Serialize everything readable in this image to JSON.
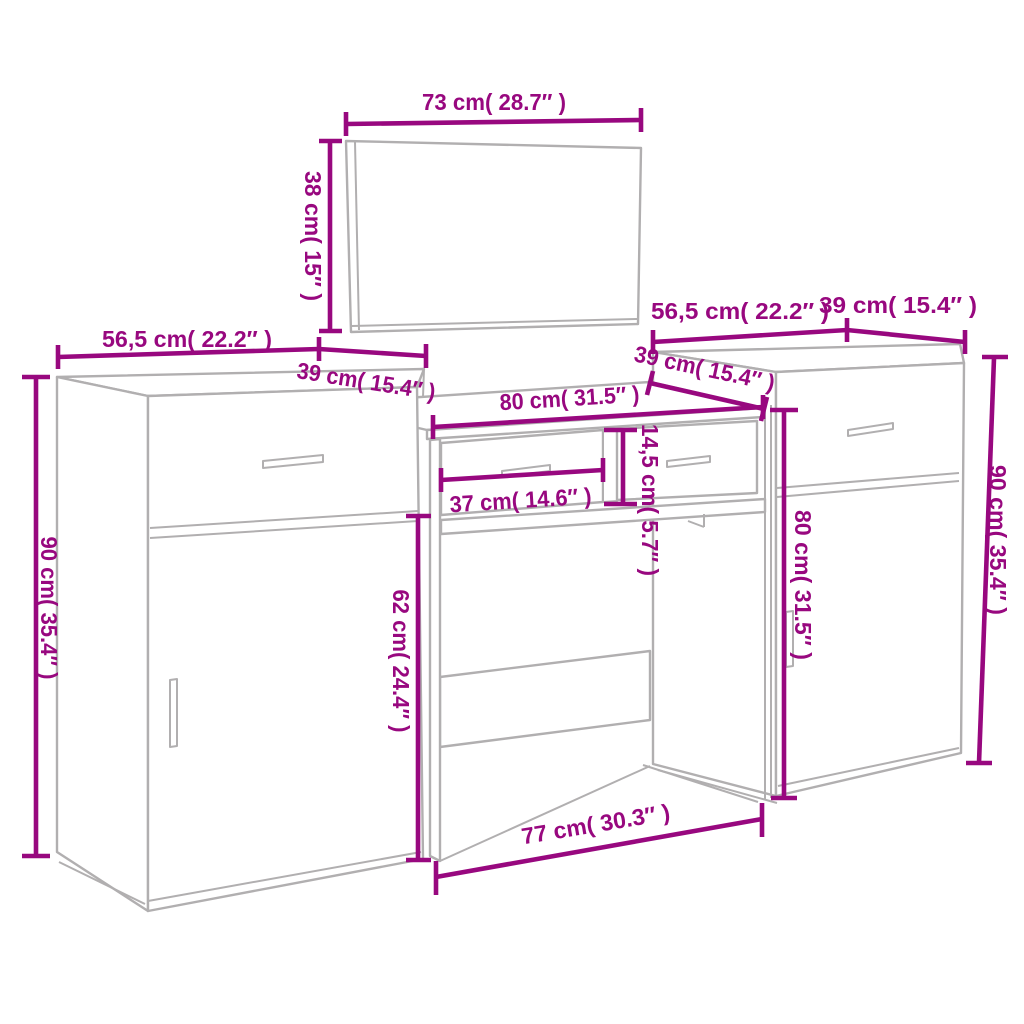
{
  "diagram": {
    "kind": "furniture-dimension-diagram",
    "colors": {
      "dimension": "#98087f",
      "furniture_outline": "#b1afb0",
      "background": "#ffffff"
    },
    "units": {
      "metric": "cm",
      "imperial": "in"
    },
    "pieces": {
      "mirror": {
        "width": {
          "cm": "73",
          "in": "28.7",
          "label": "73 cm( 28.7″ )"
        },
        "height": {
          "cm": "38",
          "in": "15",
          "label": "38 cm( 15″ )"
        }
      },
      "left_cabinet": {
        "width": {
          "cm": "56,5",
          "in": "22.2",
          "label": "56,5 cm( 22.2″ )"
        },
        "depth": {
          "cm": "39",
          "in": "15.4",
          "label": "39 cm( 15.4″ )"
        },
        "height": {
          "cm": "90",
          "in": "35.4",
          "label": "90 cm( 35.4″ )"
        }
      },
      "dressing_table": {
        "width": {
          "cm": "80",
          "in": "31.5",
          "label": "80 cm( 31.5″ )"
        },
        "depth": {
          "cm": "39",
          "in": "15.4",
          "label": "39 cm( 15.4″ )"
        },
        "drawer_width": {
          "cm": "37",
          "in": "14.6",
          "label": "37 cm( 14.6″ )"
        },
        "drawer_height": {
          "cm": "14,5",
          "in": "5.7",
          "label": "14,5 cm( 5.7″ )"
        },
        "leg_height": {
          "cm": "62",
          "in": "24.4",
          "label": "62 cm( 24.4″ )"
        },
        "base_width": {
          "cm": "77",
          "in": "30.3",
          "label": "77 cm( 30.3″ )"
        }
      },
      "right_cabinet": {
        "width": {
          "cm": "56,5",
          "in": "22.2",
          "label": "56,5 cm( 22.2″ )"
        },
        "depth": {
          "cm": "39",
          "in": "15.4",
          "label": "39 cm( 15.4″ )"
        },
        "height": {
          "cm": "90",
          "in": "35.4",
          "label": "90 cm( 35.4″ )"
        },
        "side_height": {
          "cm": "80",
          "in": "31.5",
          "label": "80 cm( 31.5″ )"
        }
      }
    }
  }
}
